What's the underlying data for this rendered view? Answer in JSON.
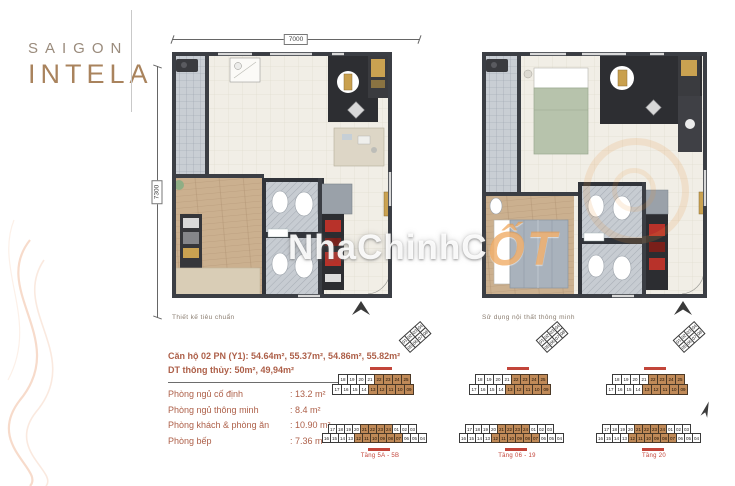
{
  "logo": {
    "top": "SAIGON",
    "bottom": "INTELA"
  },
  "watermark": {
    "text": "NhaChinhC",
    "accent": "ỐT"
  },
  "left_plan": {
    "dim_top": "7000",
    "dim_left": "7300",
    "caption": "Thiết kế tiêu chuẩn"
  },
  "right_plan": {
    "caption": "Sử dụng nội thất thông minh"
  },
  "specs": {
    "title": "Căn hộ 02 PN (Y1): 54.64m², 55.37m², 54.86m², 55.82m²",
    "subtitle": "DT thông thủy: 50m², 49,94m²",
    "rows": [
      {
        "label": "Phòng ngủ cố định",
        "value": ": 13.2 m²"
      },
      {
        "label": "Phòng ngủ thông minh",
        "value": ": 8.4 m²"
      },
      {
        "label": "Phòng khách & phòng ăn",
        "value": ": 10.90 m²"
      },
      {
        "label": "Phòng bếp",
        "value": ": 7.36 m²"
      }
    ]
  },
  "keyplans": {
    "clusters": [
      {
        "label": "Tầng 5A - 5B"
      },
      {
        "label": "Tầng 06 - 19"
      },
      {
        "label": "Tầng 20"
      }
    ],
    "top_rows": [
      {
        "cells": [
          "18",
          "19",
          "20",
          "21",
          "22",
          "23",
          "24",
          "25"
        ],
        "hl": [
          4,
          8
        ]
      },
      {
        "cells": [
          "17",
          "16",
          "15",
          "14",
          "13",
          "12",
          "11",
          "10",
          "09"
        ],
        "hl": [
          4,
          9
        ]
      }
    ],
    "tail_cells": [
      "01",
      "02",
      "03",
      "04",
      "05",
      "06",
      "07",
      "08"
    ],
    "bottom_rows": [
      {
        "cells": [
          "17",
          "18",
          "19",
          "20",
          "21",
          "22",
          "23",
          "24",
          "01",
          "02",
          "03"
        ],
        "hl": [
          4,
          8
        ]
      },
      {
        "cells": [
          "16",
          "15",
          "14",
          "13",
          "12",
          "11",
          "10",
          "09",
          "08",
          "07",
          "06",
          "05",
          "04"
        ],
        "hl": [
          4,
          10
        ]
      }
    ]
  },
  "colors": {
    "accent_text": "#ad5f48",
    "label_red": "#c2453a",
    "cell_highlight": "#c08a58",
    "wall": "#3b3e44",
    "gold": "#c9a04e",
    "logo_brown": "#a9835d",
    "logo_gray": "#9a8b7c",
    "watermark_orange": "#eb943a"
  }
}
